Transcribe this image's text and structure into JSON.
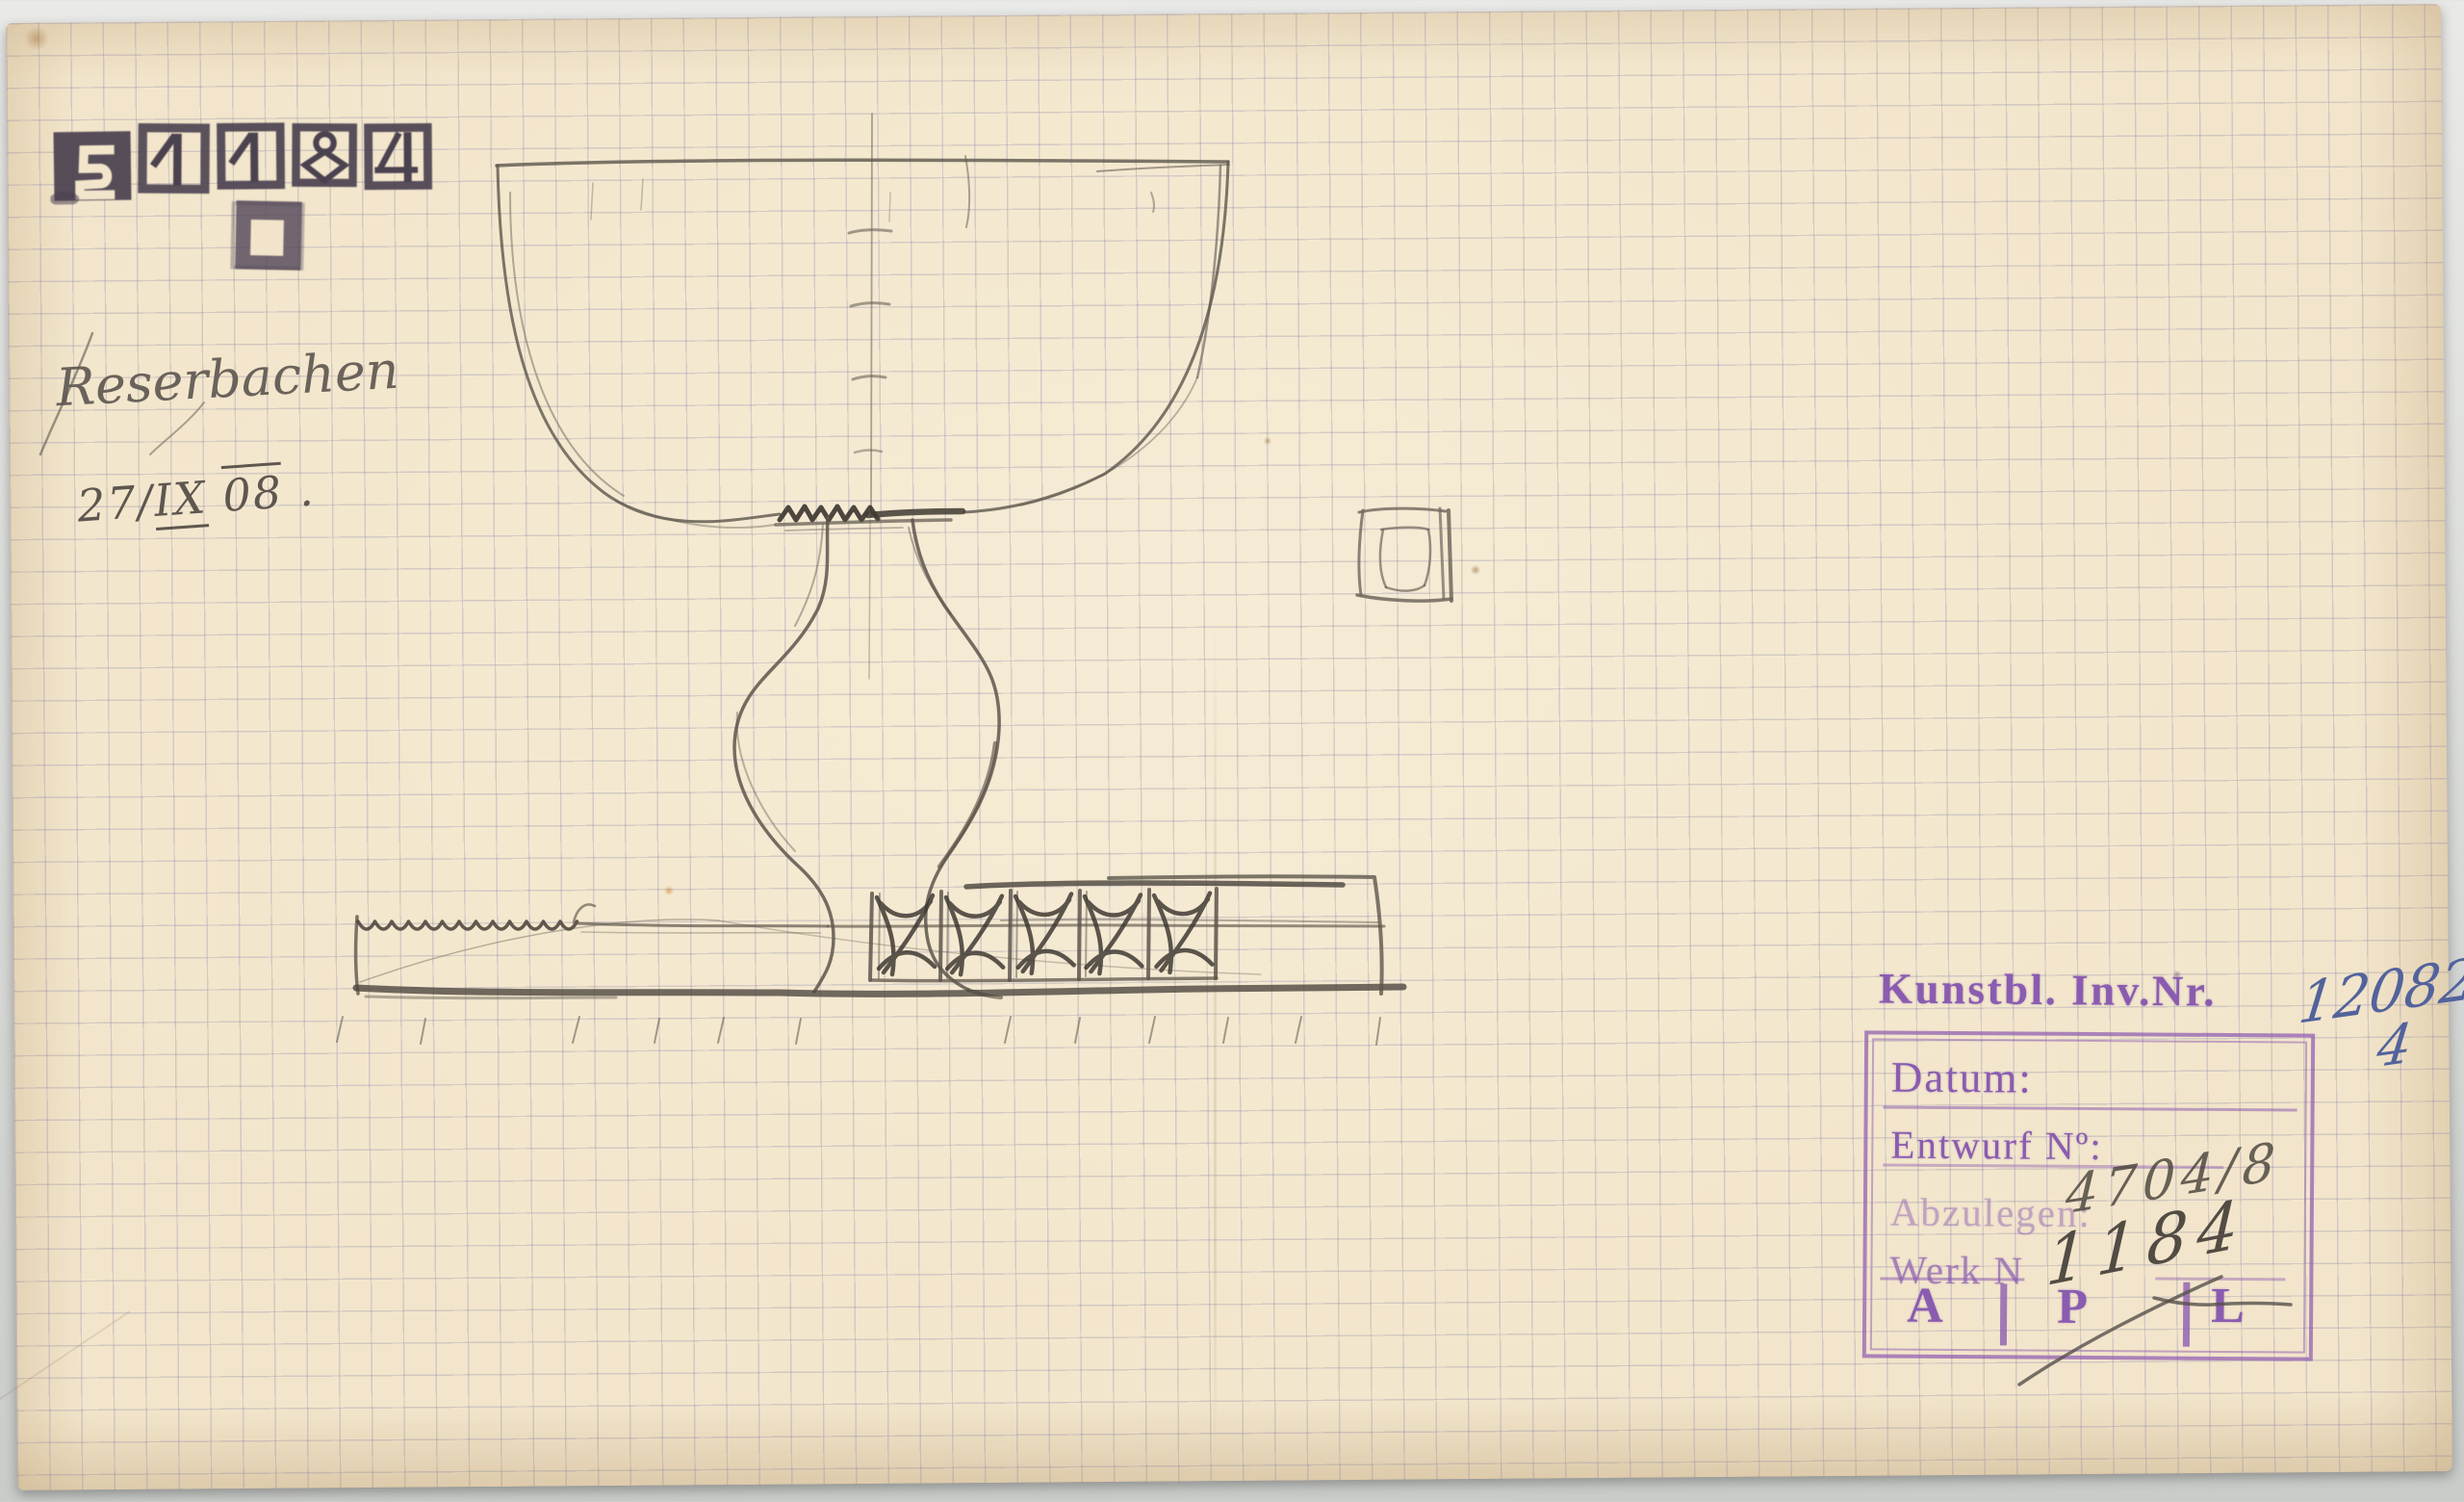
{
  "colors": {
    "paper": "#f2e5cb",
    "scan_background": "#d6d8d5",
    "grid_line": "#8c8aa6",
    "pencil_dark": "#3a342e",
    "pencil_mid": "#5d564c",
    "stamp_ink_dark": "#4b4250",
    "stamp_ink_purple": "#8a5cb0",
    "ink_blue": "#52639c"
  },
  "number_stamp": {
    "value": "51184",
    "digits": [
      "5",
      "1",
      "1",
      "8",
      "4"
    ]
  },
  "handwriting": {
    "signature": "Reserbachen",
    "date_prefix": "27/",
    "date_month": "IX",
    "date_year": "08",
    "date_suffix": " ."
  },
  "inventory": {
    "label": "Kunstbl. Inv.Nr.",
    "number": "12082/",
    "number_suffix": "4"
  },
  "stamp_box": {
    "rows": [
      {
        "label": "Datum:",
        "value": ""
      },
      {
        "label": "Entwurf Nº:",
        "value": ""
      },
      {
        "label": "Abzulegen:",
        "value": "4704/8"
      },
      {
        "label": "Werk N",
        "value": "1184"
      }
    ],
    "letters": [
      "A",
      "P",
      "L"
    ]
  },
  "sketch": {
    "main_subject": "footed bowl (goblet) elevation with ornamented base band",
    "secondary_subject": "small square ornament detail"
  }
}
